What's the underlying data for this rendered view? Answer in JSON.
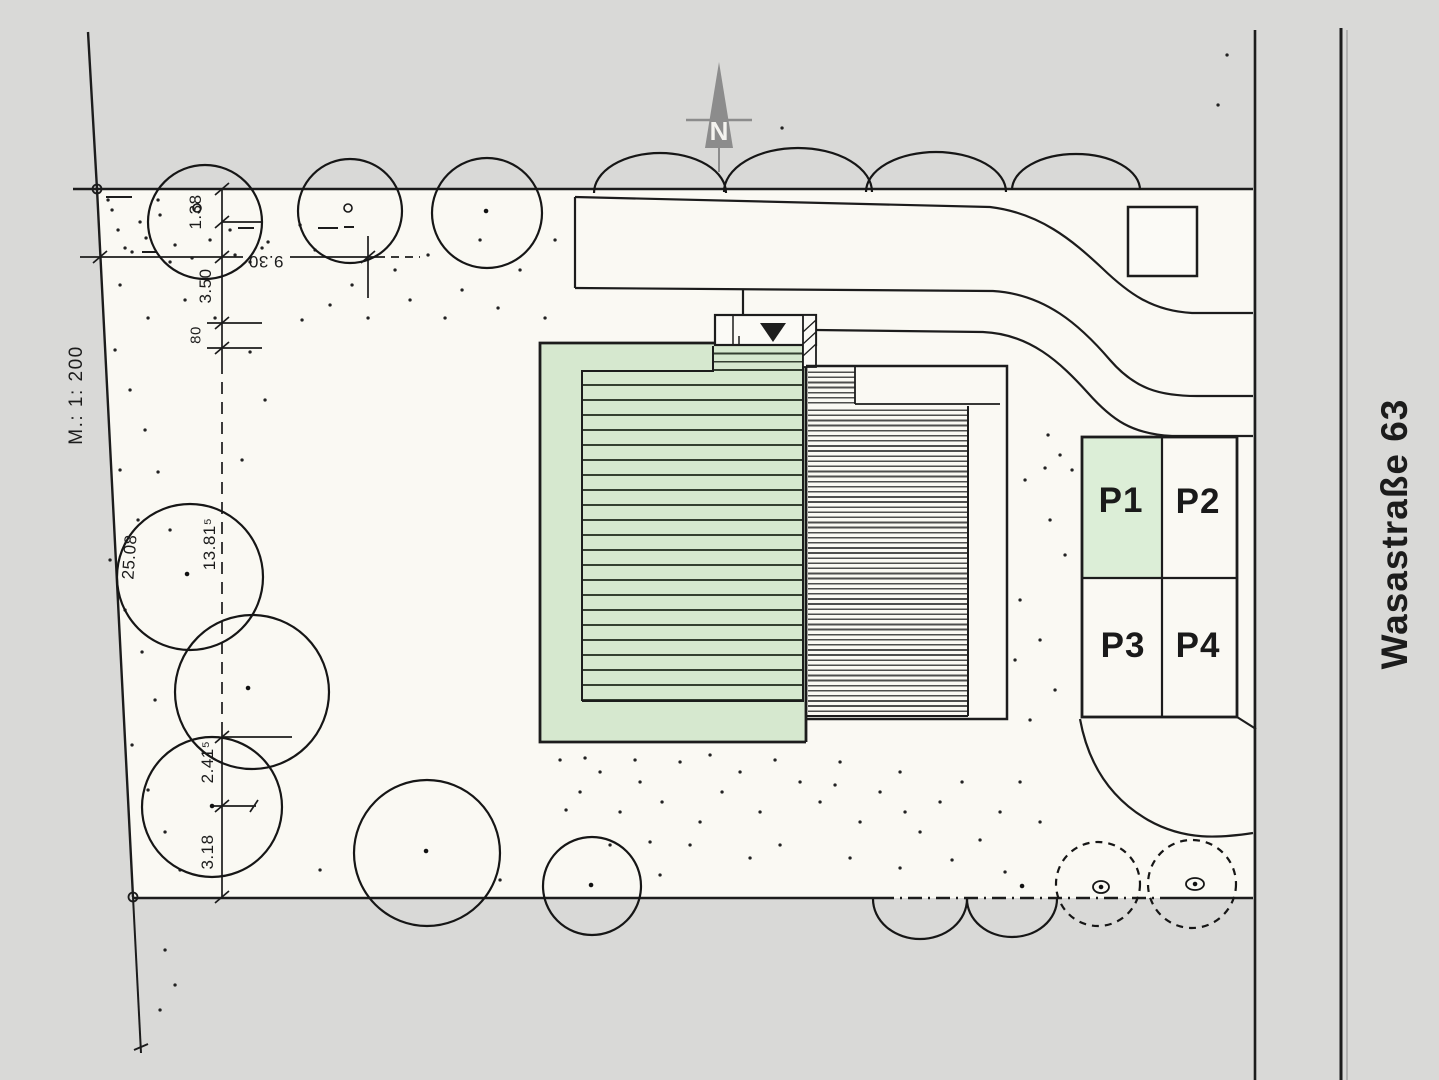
{
  "plan": {
    "north_label": "N",
    "scale_label": "M.: 1: 200",
    "street_label": "Wasastraße 63",
    "parking_spaces": [
      {
        "label": "P1",
        "highlighted": true
      },
      {
        "label": "P2",
        "highlighted": false
      },
      {
        "label": "P3",
        "highlighted": false
      },
      {
        "label": "P4",
        "highlighted": false
      }
    ],
    "dimensions": {
      "seg_a": "1.38",
      "seg_b": "3.50",
      "seg_c": "80",
      "width_top": "9.30",
      "boundary_left": "25.08",
      "seg_mid": "13.81⁵",
      "seg_d": "2.41⁵",
      "seg_e": "3.18"
    },
    "colors": {
      "building_green": "#d6e8cf",
      "parking_highlight_green": "#dceed7",
      "paper_gray": "#d9d9d7",
      "paper_white": "#faf9f3",
      "ink": "#1c1c1c",
      "north_arrow_gray": "#8c8c8c"
    }
  }
}
